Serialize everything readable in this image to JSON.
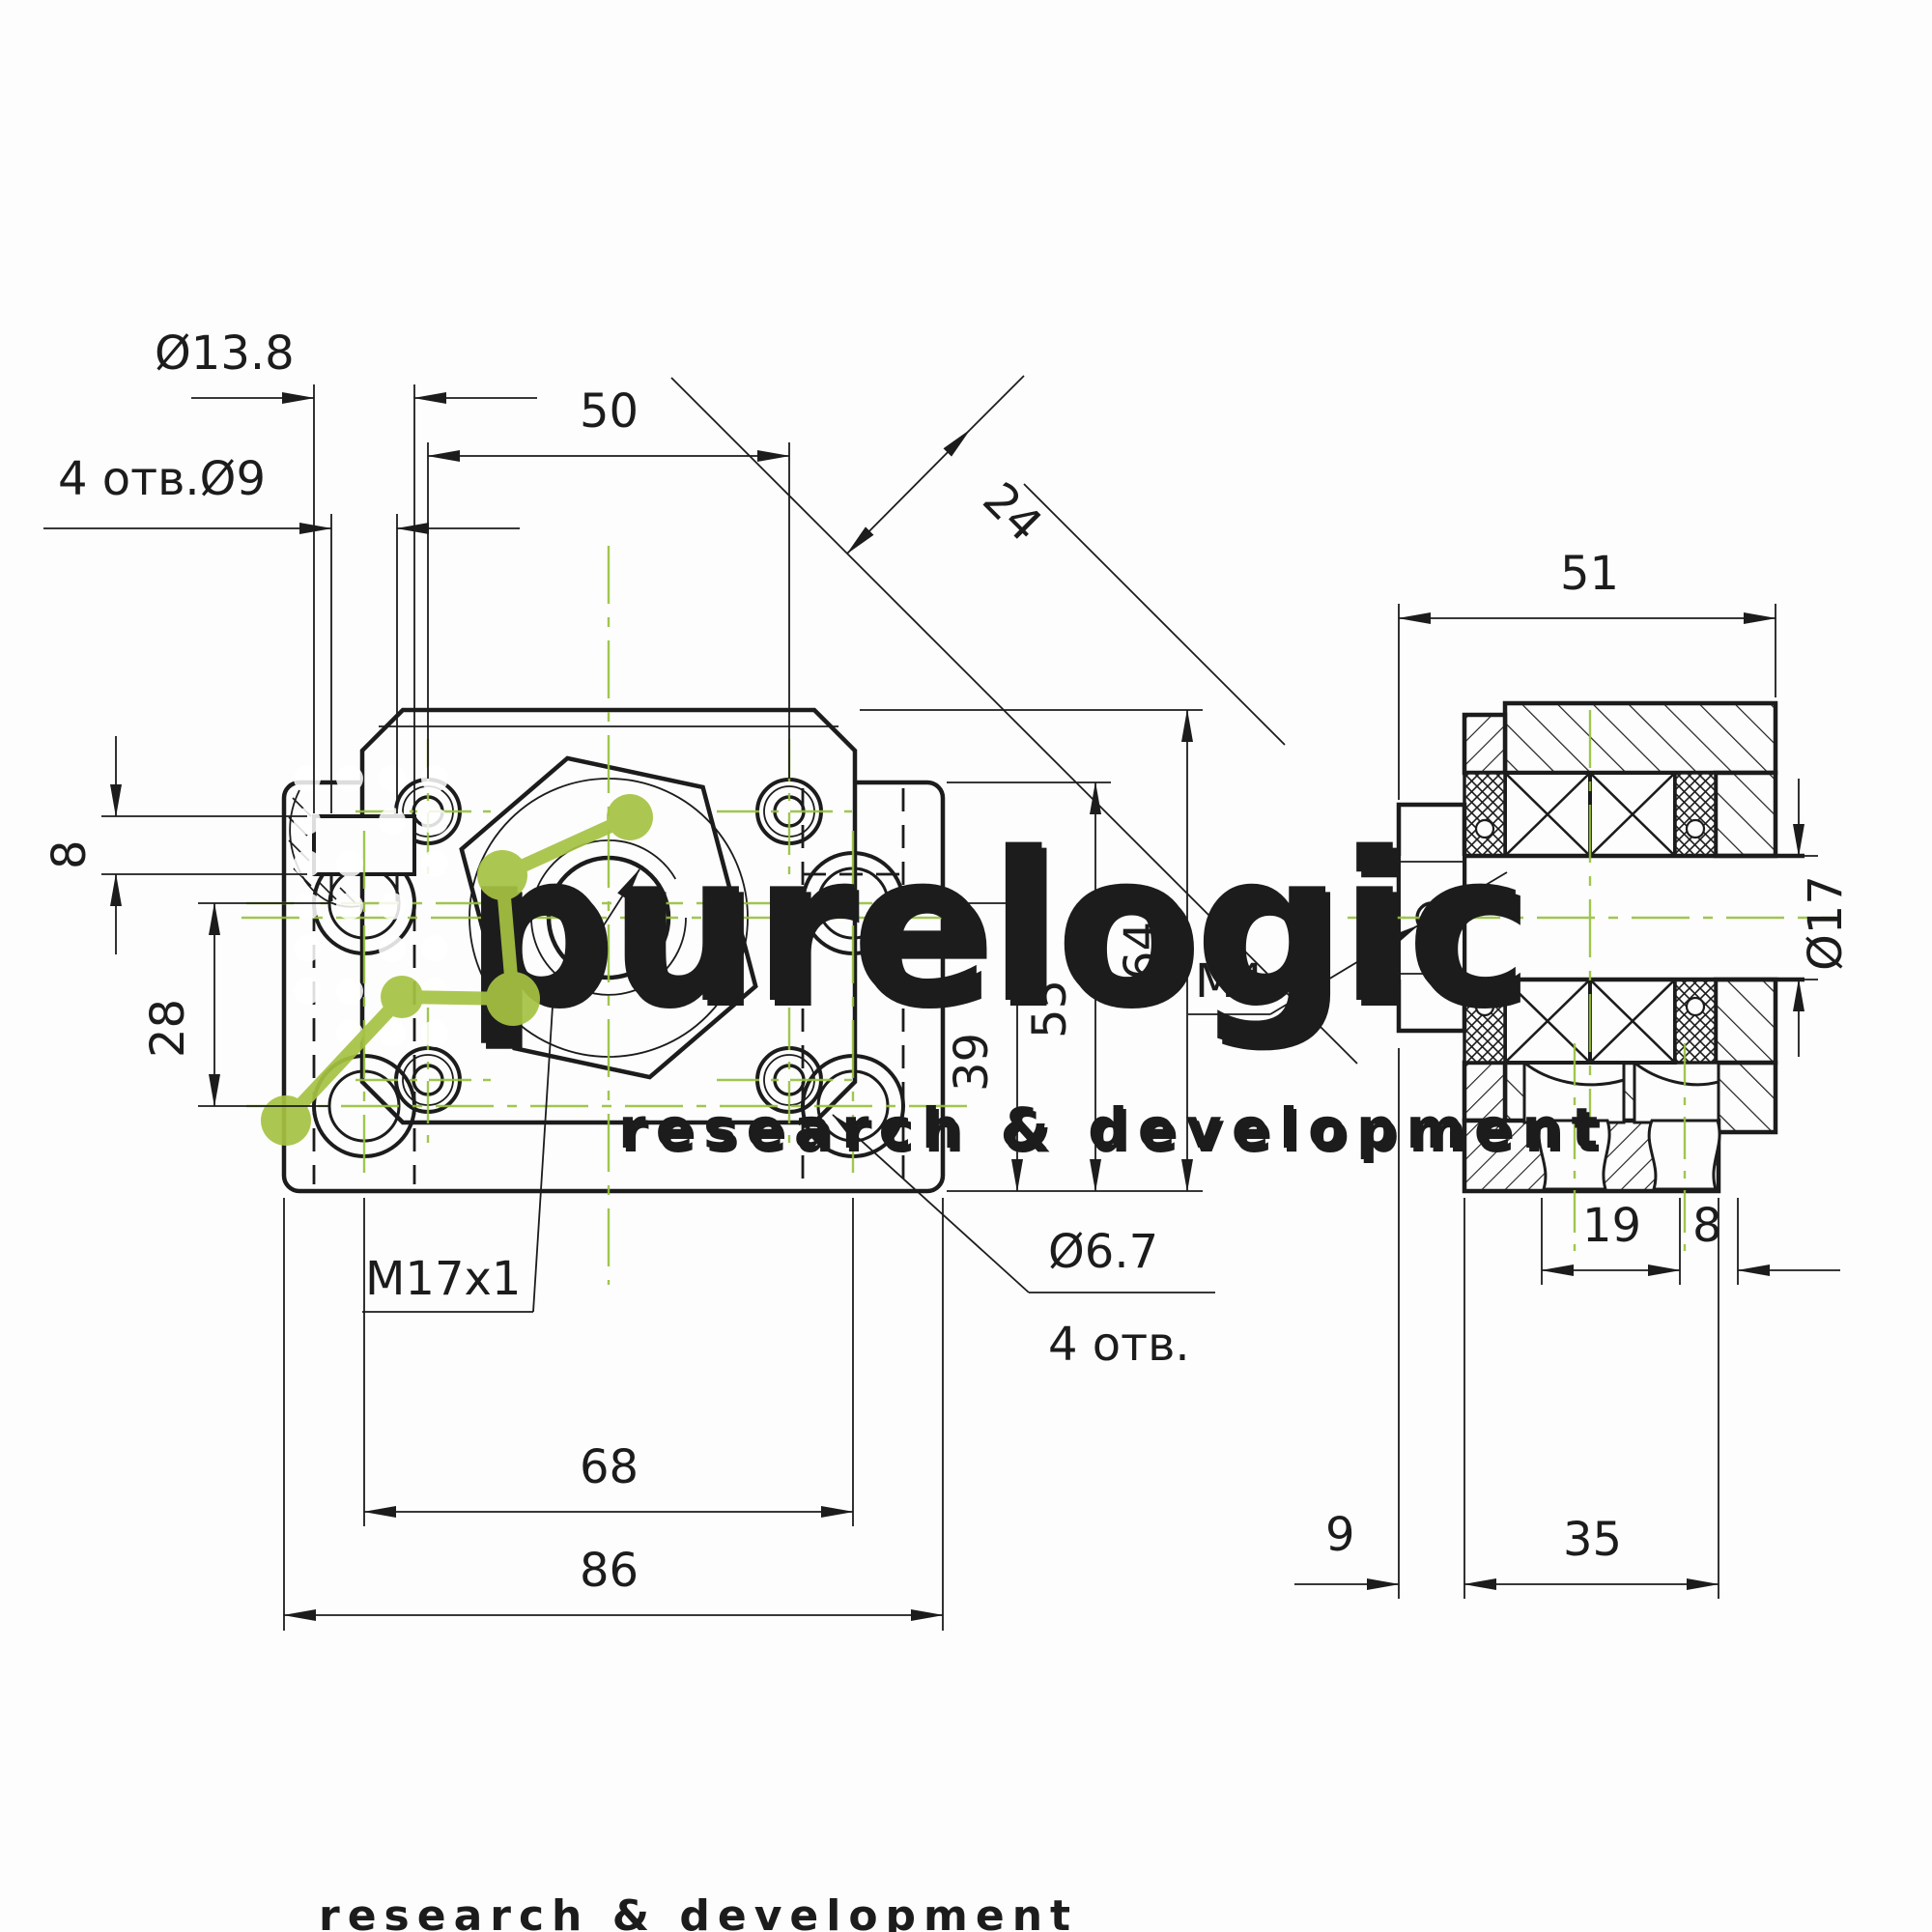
{
  "drawing": {
    "front": {
      "dia_cbore": "Ø13.8",
      "holes_label": "4 отв.Ø9",
      "dim50": "50",
      "dim24": "24",
      "dim8": "8",
      "dim28": "28",
      "thread_label": "M17x1",
      "dim68": "68",
      "dim86": "86",
      "dia_flange_holes": "Ø6.7",
      "flange_holes_count": "4 отв.",
      "dim39": "39",
      "dim55": "55",
      "dim64": "64"
    },
    "side": {
      "dim51": "51",
      "set_screw_label": "M4",
      "dia_bore": "Ø17",
      "dim19": "19",
      "dim8": "8",
      "dim9": "9",
      "dim35": "35"
    },
    "watermark": {
      "brand": "purelogic",
      "tagline": "research & development"
    },
    "colors": {
      "line": "#1c1c1c",
      "centerline": "#97c13d",
      "logo_green": "#a6c343"
    }
  }
}
